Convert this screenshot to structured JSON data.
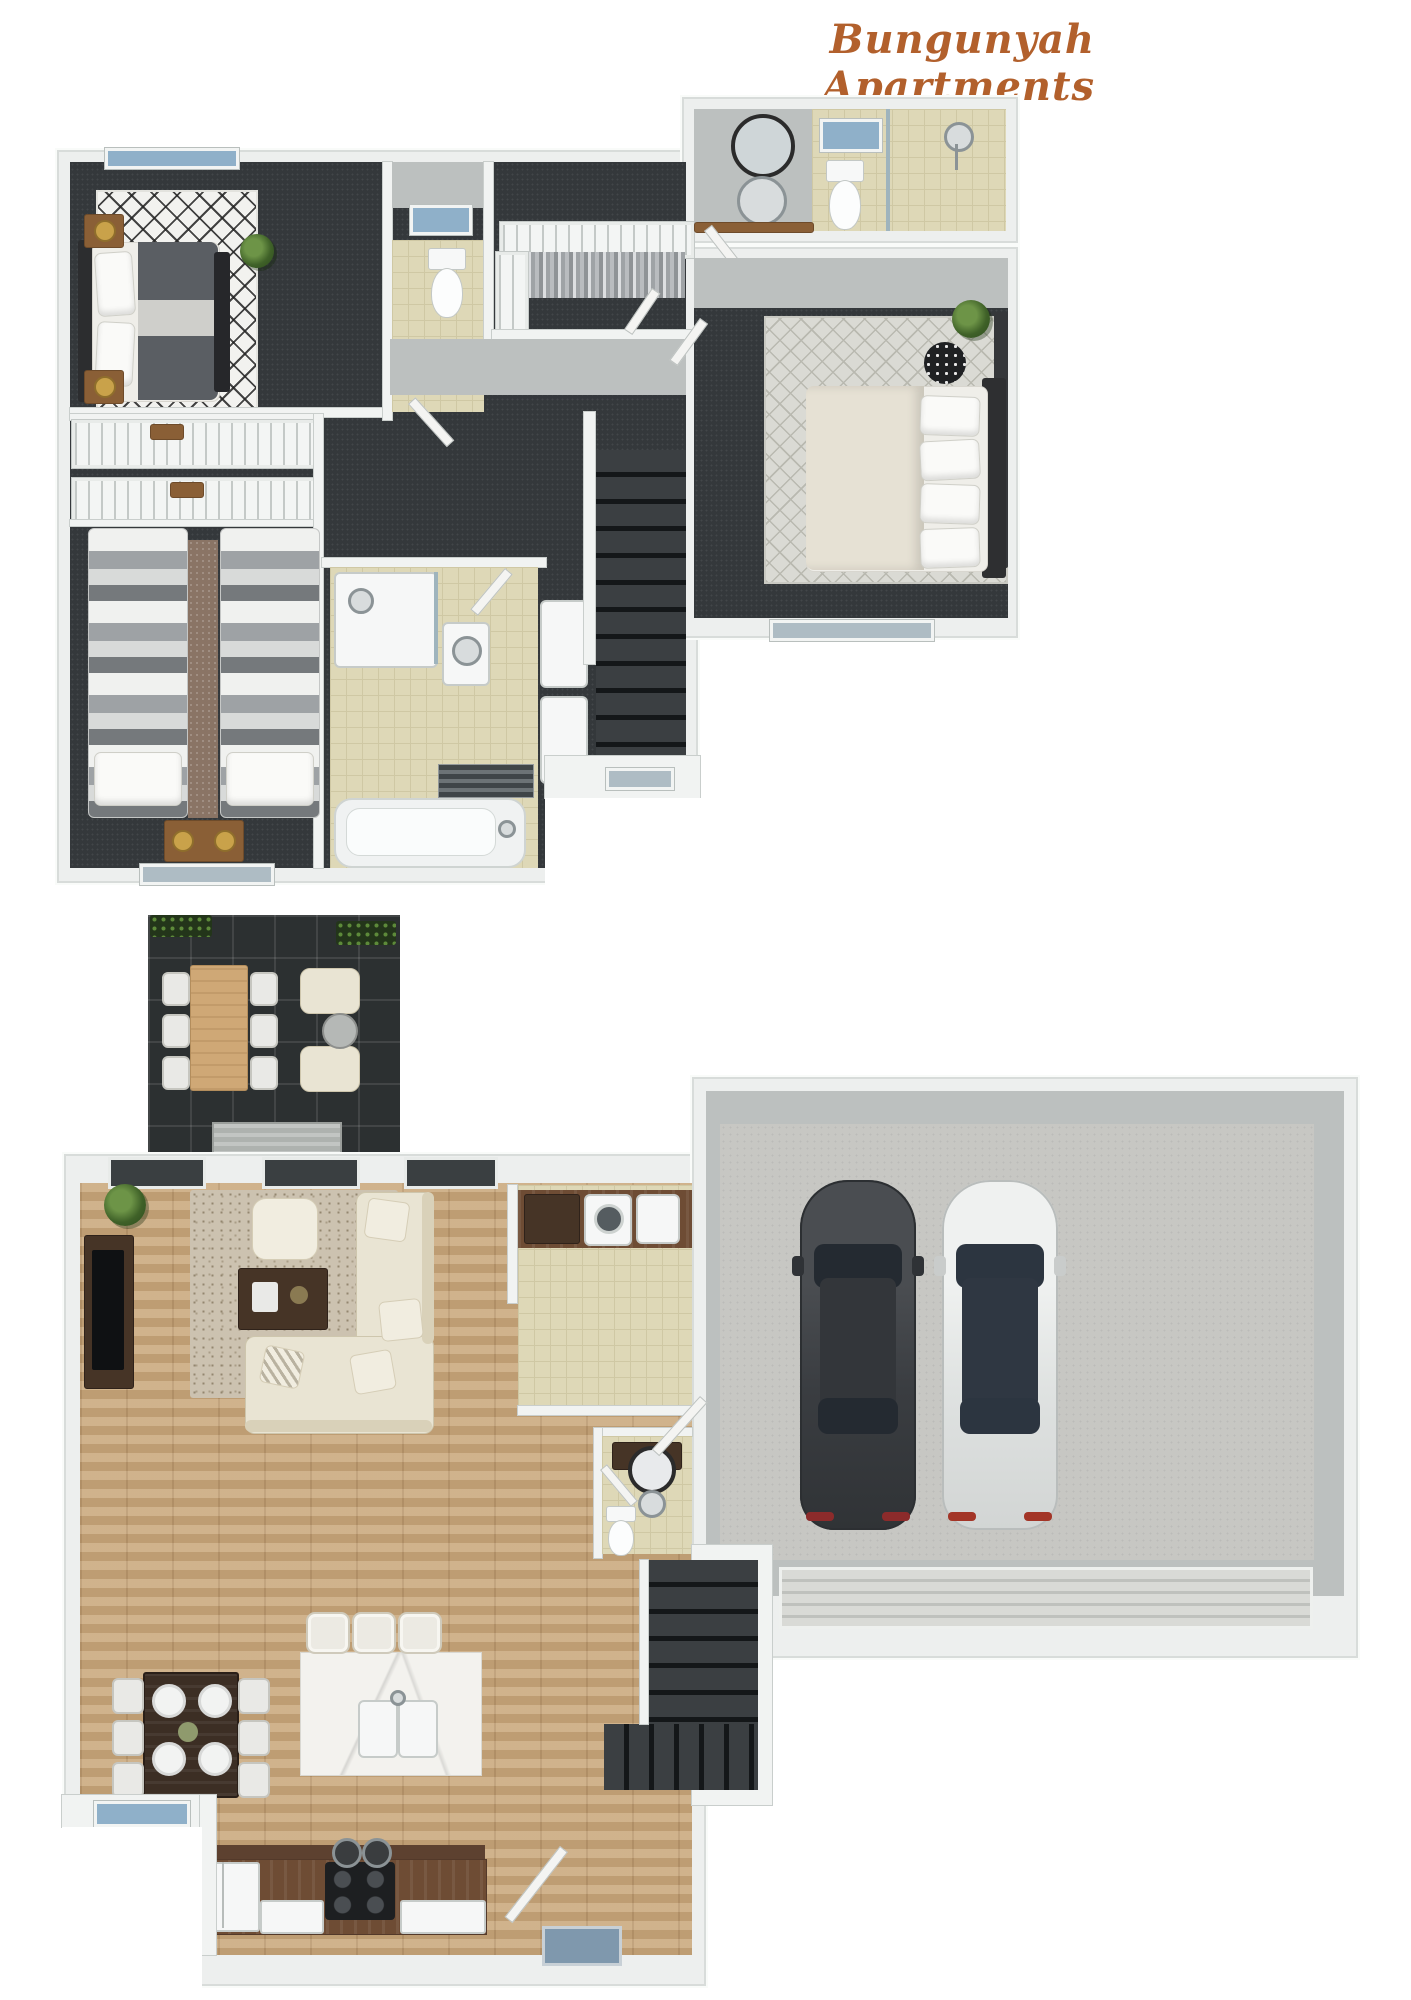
{
  "title": "Bungunyah Apartments",
  "palette": {
    "accent": "#b2602c",
    "wall": "#edefee",
    "carpet": "#34383b",
    "tile": "#ded8b7",
    "wood_floor": "#cbaa7f",
    "patio_tile": "#2c3031",
    "concrete": "#c7c7c3",
    "glass_window": "#8fb0c9"
  },
  "floors": {
    "upper": {
      "name": "upper-floor-plan",
      "rooms": [
        "master-bedroom",
        "ensuite-bathroom",
        "walk-in-robe",
        "wc",
        "hallway",
        "staircase",
        "second-bedroom",
        "third-bedroom",
        "family-bathroom"
      ],
      "furniture": [
        "double-bed",
        "nightstands",
        "lamps",
        "chevron-rug",
        "wardrobes",
        "twin-beds",
        "bathtub",
        "shower",
        "toilet",
        "vanity-mirror",
        "hanging-clothes"
      ]
    },
    "lower": {
      "name": "lower-floor-plan",
      "rooms": [
        "patio",
        "living-room",
        "dining-area",
        "kitchen",
        "laundry",
        "powder-room",
        "entry",
        "staircase",
        "double-garage"
      ],
      "furniture": [
        "outdoor-dining-set",
        "lounge-chairs",
        "corner-sofa",
        "coffee-table",
        "tv-console",
        "dining-table",
        "kitchen-island",
        "bar-stools",
        "fridge",
        "cooktop",
        "washer",
        "two-cars",
        "entry-mat"
      ],
      "cars": [
        "dark-grey-car",
        "white-car"
      ]
    }
  }
}
